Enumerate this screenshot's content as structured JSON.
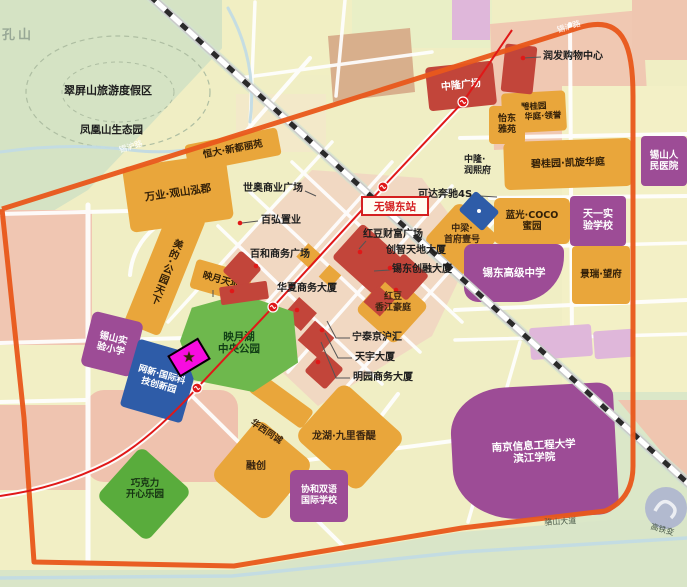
{
  "colors": {
    "boundary": "#E8581C",
    "metro": "#E01818",
    "orange": "#E9A63B",
    "red": "#C2453A",
    "purple": "#9D4C96",
    "blue": "#2E5CA8",
    "park": "#6EB84D",
    "target": "#F70CE0",
    "star": "#FFD700"
  },
  "region_labels": {
    "kongshan": "孔山",
    "cuiping": "翠屏山旅游度假区",
    "fenghuang": "凤凰山生态园"
  },
  "station": {
    "label": "无锡东站"
  },
  "roads": {
    "xihu": "锡沪路",
    "luoshan": "骆山大道",
    "gaotiebian": "高铁变"
  },
  "places": {
    "wanye": {
      "label": "万业·观山泓郡"
    },
    "hengda": {
      "label": "恒大·新都丽苑"
    },
    "meidi": {
      "label": "美的·公园天下"
    },
    "yingyue_tiandi": {
      "label": "映月天地"
    },
    "shiao": {
      "label": "世奥商业广场"
    },
    "baihong": {
      "label": "百弘置业"
    },
    "baihe": {
      "label": "百和商务广场"
    },
    "huasha": {
      "label": "华夏商务大厦"
    },
    "hongdou_fortune": {
      "label": "红豆财富广场"
    },
    "chuangzhi": {
      "label": "创智天地大厦"
    },
    "xidong_chuangrong": {
      "label": "锡东创融大厦"
    },
    "keda": {
      "label": "可达奔驰4S"
    },
    "zhonglong": {
      "label": "中隆广场"
    },
    "runfa": {
      "label": "润发购物中心"
    },
    "yidong": {
      "label": "怡东\n雅苑"
    },
    "zhonglong_runxi": {
      "label": "中隆·\n润熙府"
    },
    "bgy_lingyu": {
      "label": "碧桂园\n凯旋华庭·领誉"
    },
    "bgy": {
      "label": "碧桂园·凯旋华庭"
    },
    "languang": {
      "label": "蓝光·COCO\n蜜园"
    },
    "tianyi": {
      "label": "天一实\n验学校"
    },
    "hospital": {
      "label": "锡山人\n民医院"
    },
    "jingrui": {
      "label": "景瑞·望府"
    },
    "xidong_hs": {
      "label": "锡东高级中学"
    },
    "zhongliang": {
      "label": "中梁·\n首府壹号"
    },
    "hongdou_xj": {
      "label": "红豆\n香江豪庭"
    },
    "ningtai": {
      "label": "宁泰京沪汇"
    },
    "tianyu": {
      "label": "天宇大厦"
    },
    "mingyuan": {
      "label": "明园商务大厦"
    },
    "park": {
      "label": "映月湖\n中央公园"
    },
    "primary": {
      "label": "锡山实\n验小学"
    },
    "wangxin": {
      "label": "网新·国际科\n技创新园"
    },
    "chocolate": {
      "label": "巧克力\n开心乐园"
    },
    "huaxi": {
      "label": "华西同诚"
    },
    "longhu": {
      "label": "龙湖·九里香醍"
    },
    "rongchuang": {
      "label": "融创"
    },
    "xiehe": {
      "label": "协和双语\n国际学校"
    },
    "univ": {
      "label": "南京信息工程大学\n滨江学院"
    }
  }
}
